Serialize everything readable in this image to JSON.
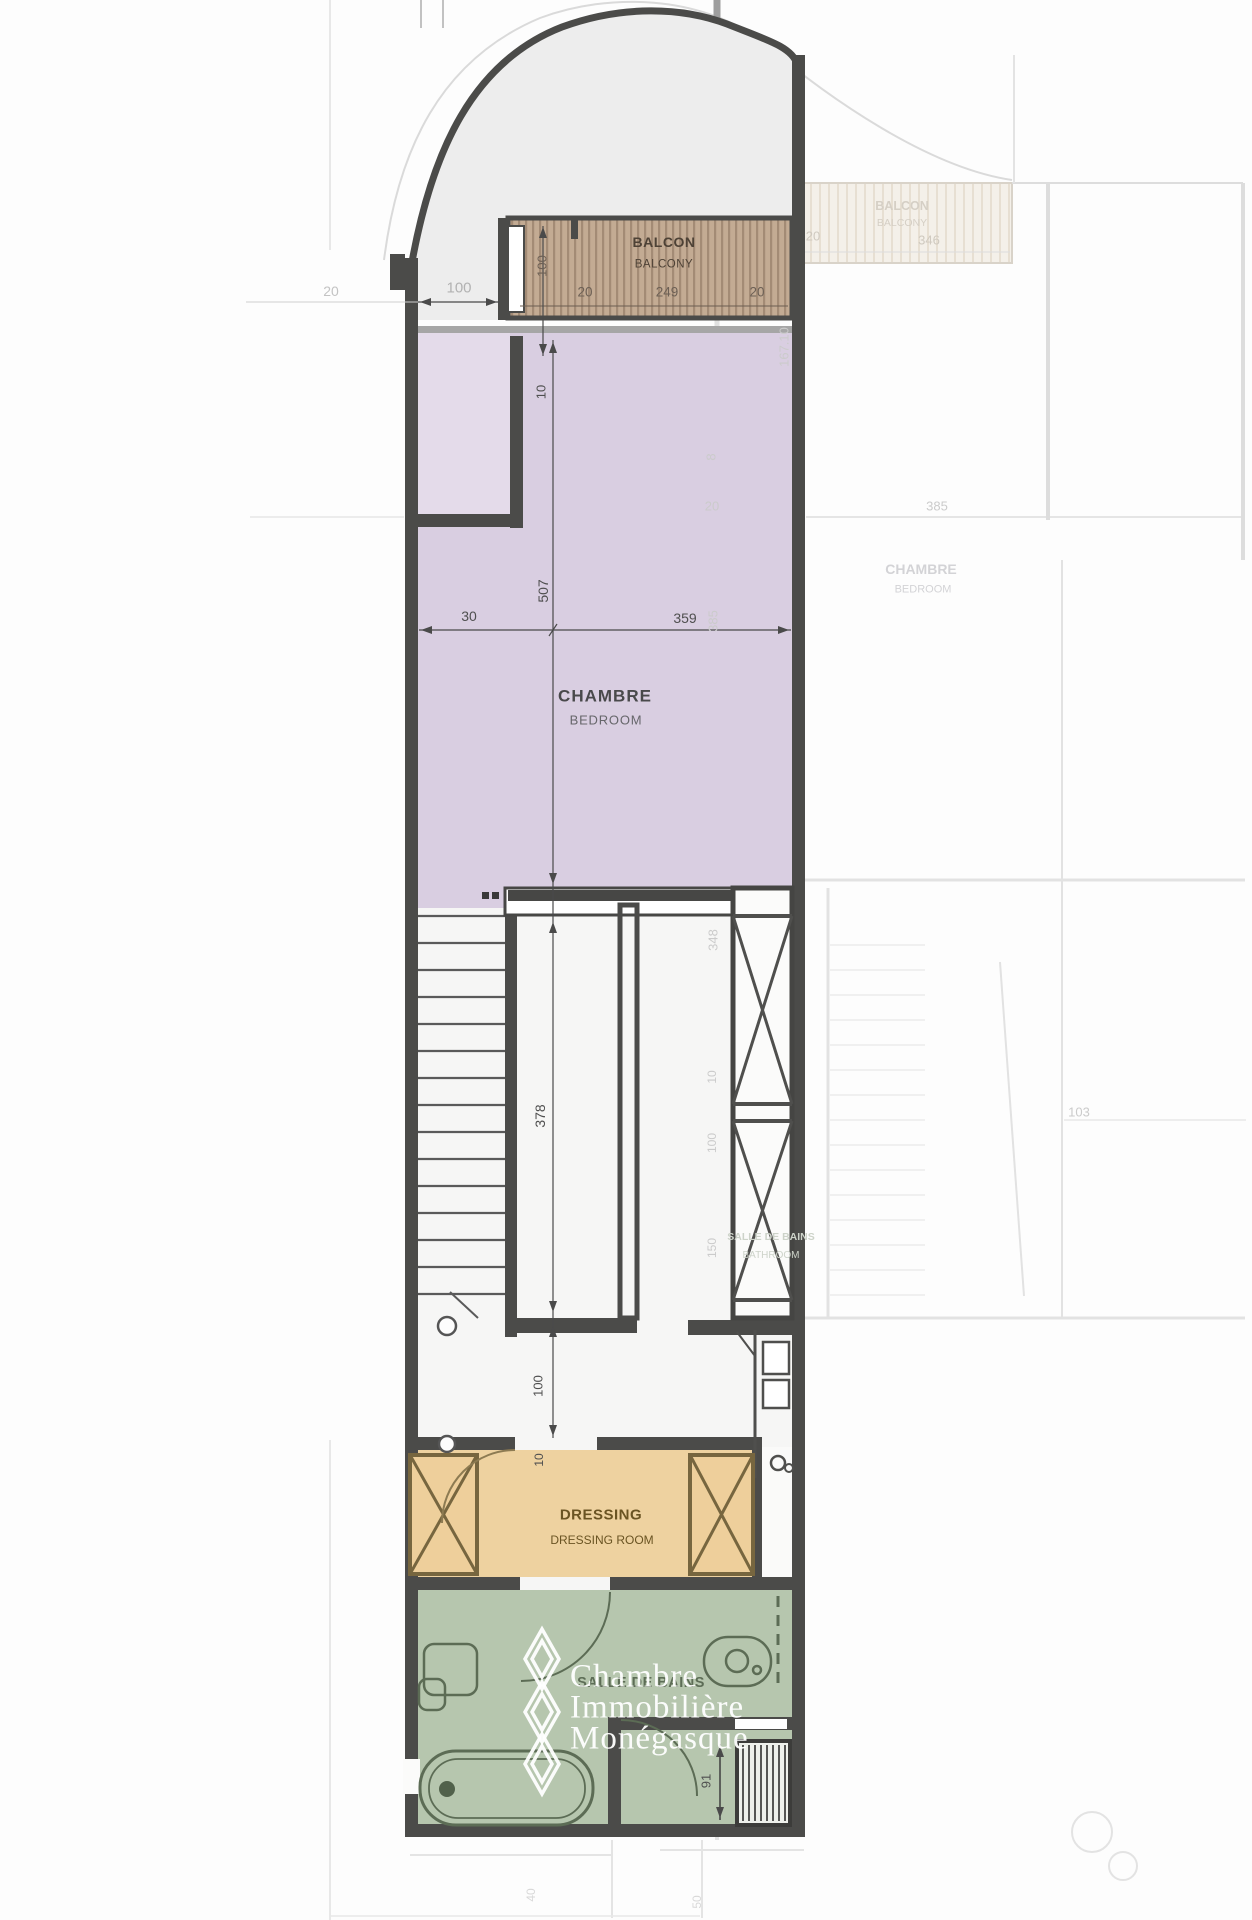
{
  "plan": {
    "watermark": {
      "line1": "Chambre",
      "line2": "Immobilière",
      "line3": "Monégasque"
    },
    "rooms": {
      "balcony": {
        "fr": "BALCON",
        "en": "BALCONY"
      },
      "bedroom": {
        "fr": "CHAMBRE",
        "en": "BEDROOM"
      },
      "dressing": {
        "fr": "DRESSING",
        "en": "DRESSING ROOM"
      },
      "bathroom": {
        "fr": "SALLE DE BAINS"
      }
    },
    "dims": {
      "top_left_offset": "20",
      "top_setback": "100",
      "balcony_left_wall": "20",
      "balcony_width": "249",
      "balcony_right_wall": "20",
      "balcony_depth": "100",
      "balcony_wall": "10",
      "bedroom_left": "30",
      "bedroom_width": "359",
      "bedroom_depth": "507",
      "stair_depth": "378",
      "hall_depth": "100",
      "hall_wall": "10",
      "bath_door": "91"
    },
    "faded": {
      "rooms": {
        "balcony": {
          "fr": "BALCON",
          "en": "BALCONY"
        },
        "bedroom": {
          "fr": "CHAMBRE",
          "en": "BEDROOM"
        },
        "bathroom": {
          "fr": "SALLE DE BAINS",
          "en": "BATHROOM"
        }
      },
      "dims": {
        "balcony_wall": "20",
        "balcony_width": "346",
        "height_167": "167.10",
        "w8": "8",
        "wall20": "20",
        "unit_width": "385",
        "bedroom_depth": "385",
        "d103": "103",
        "stair_depth": "348",
        "d10": "10",
        "d100": "100",
        "d150": "150",
        "d40": "40",
        "d50": "50"
      }
    }
  }
}
